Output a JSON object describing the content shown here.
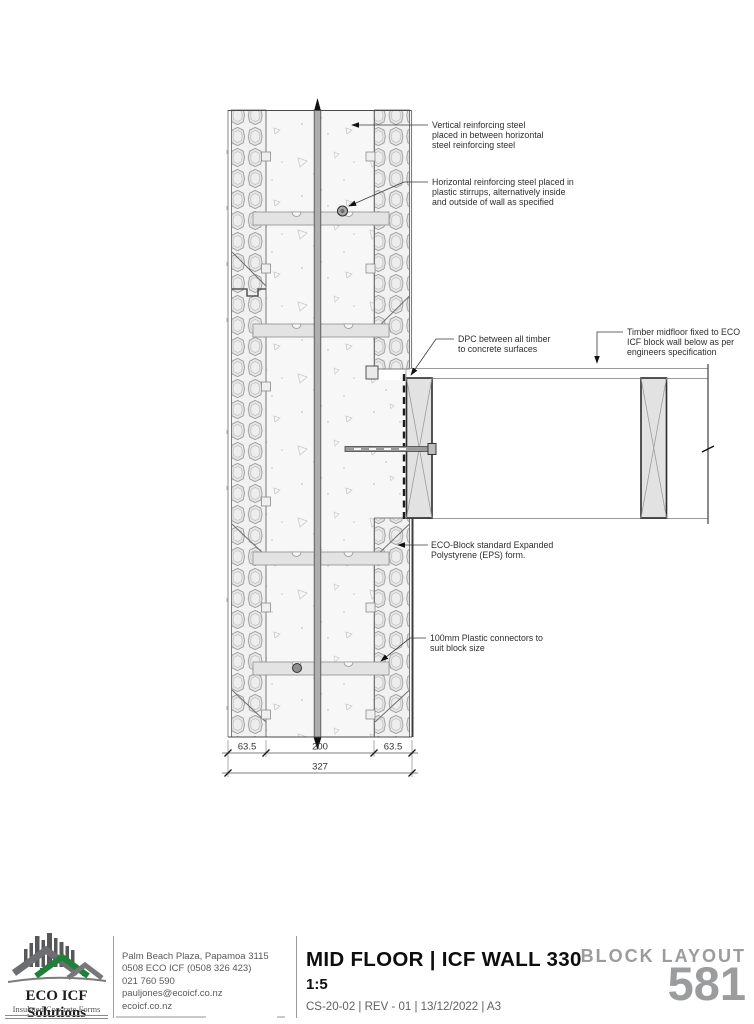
{
  "drawing": {
    "annotations": {
      "vertical_steel": [
        "Vertical reinforcing steel",
        "placed in between horizontal",
        "steel reinforcing steel"
      ],
      "horizontal_steel": [
        "Horizontal reinforcing steel placed in",
        "plastic stirrups, alternatively inside",
        "and outside of wall as specified"
      ],
      "dpc": [
        "DPC between all timber",
        "to concrete surfaces"
      ],
      "timber": [
        "Timber midfloor fixed to ECO",
        "ICF block wall below as per",
        "engineers specification"
      ],
      "eps": [
        "ECO-Block standard Expanded",
        "Polystyrene (EPS) form."
      ],
      "connectors": [
        "100mm Plastic connectors to",
        "suit block size"
      ]
    },
    "dimensions": {
      "eps_left": "63.5",
      "core": "200",
      "eps_right": "63.5",
      "overall": "327"
    }
  },
  "title_block": {
    "logo_name": "ECO ICF Solutions",
    "logo_tagline": "Insulated Concrete Forms",
    "contact": {
      "address": "Palm Beach Plaza, Papamoa 3115",
      "phone_tollfree": "0508 ECO ICF (0508 326 423)",
      "phone_mobile": "021 760 590",
      "email": "pauljones@ecoicf.co.nz",
      "website": "ecoicf.co.nz"
    },
    "title": "MID FLOOR | ICF WALL 330",
    "scale": "1:5",
    "meta": "CS-20-02  |  REV - 01  |  13/12/2022  |  A3",
    "series_label": "BLOCK LAYOUT",
    "series_number": "581"
  },
  "colors": {
    "logo_green": "#1f8038",
    "logo_grey": "#58595b",
    "series_grey": "#9b9c9e"
  }
}
